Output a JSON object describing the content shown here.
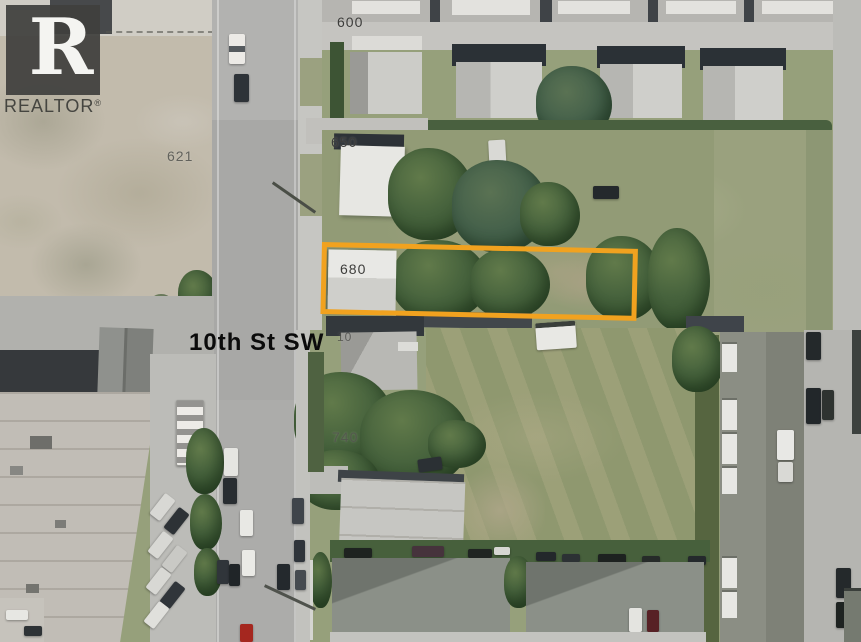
{
  "annotations": {
    "street_name": "10th St SW",
    "house_numbers": {
      "n600": "600",
      "n621": "621",
      "n650": "650",
      "n680": "680",
      "n7x0_partial": "10",
      "n740": "740"
    },
    "highlight": {
      "shape": "rectangle",
      "color": "#F1A21F"
    }
  },
  "branding": {
    "logo_letter": "R",
    "wordmark": "REALTOR",
    "registered_mark": "®"
  }
}
